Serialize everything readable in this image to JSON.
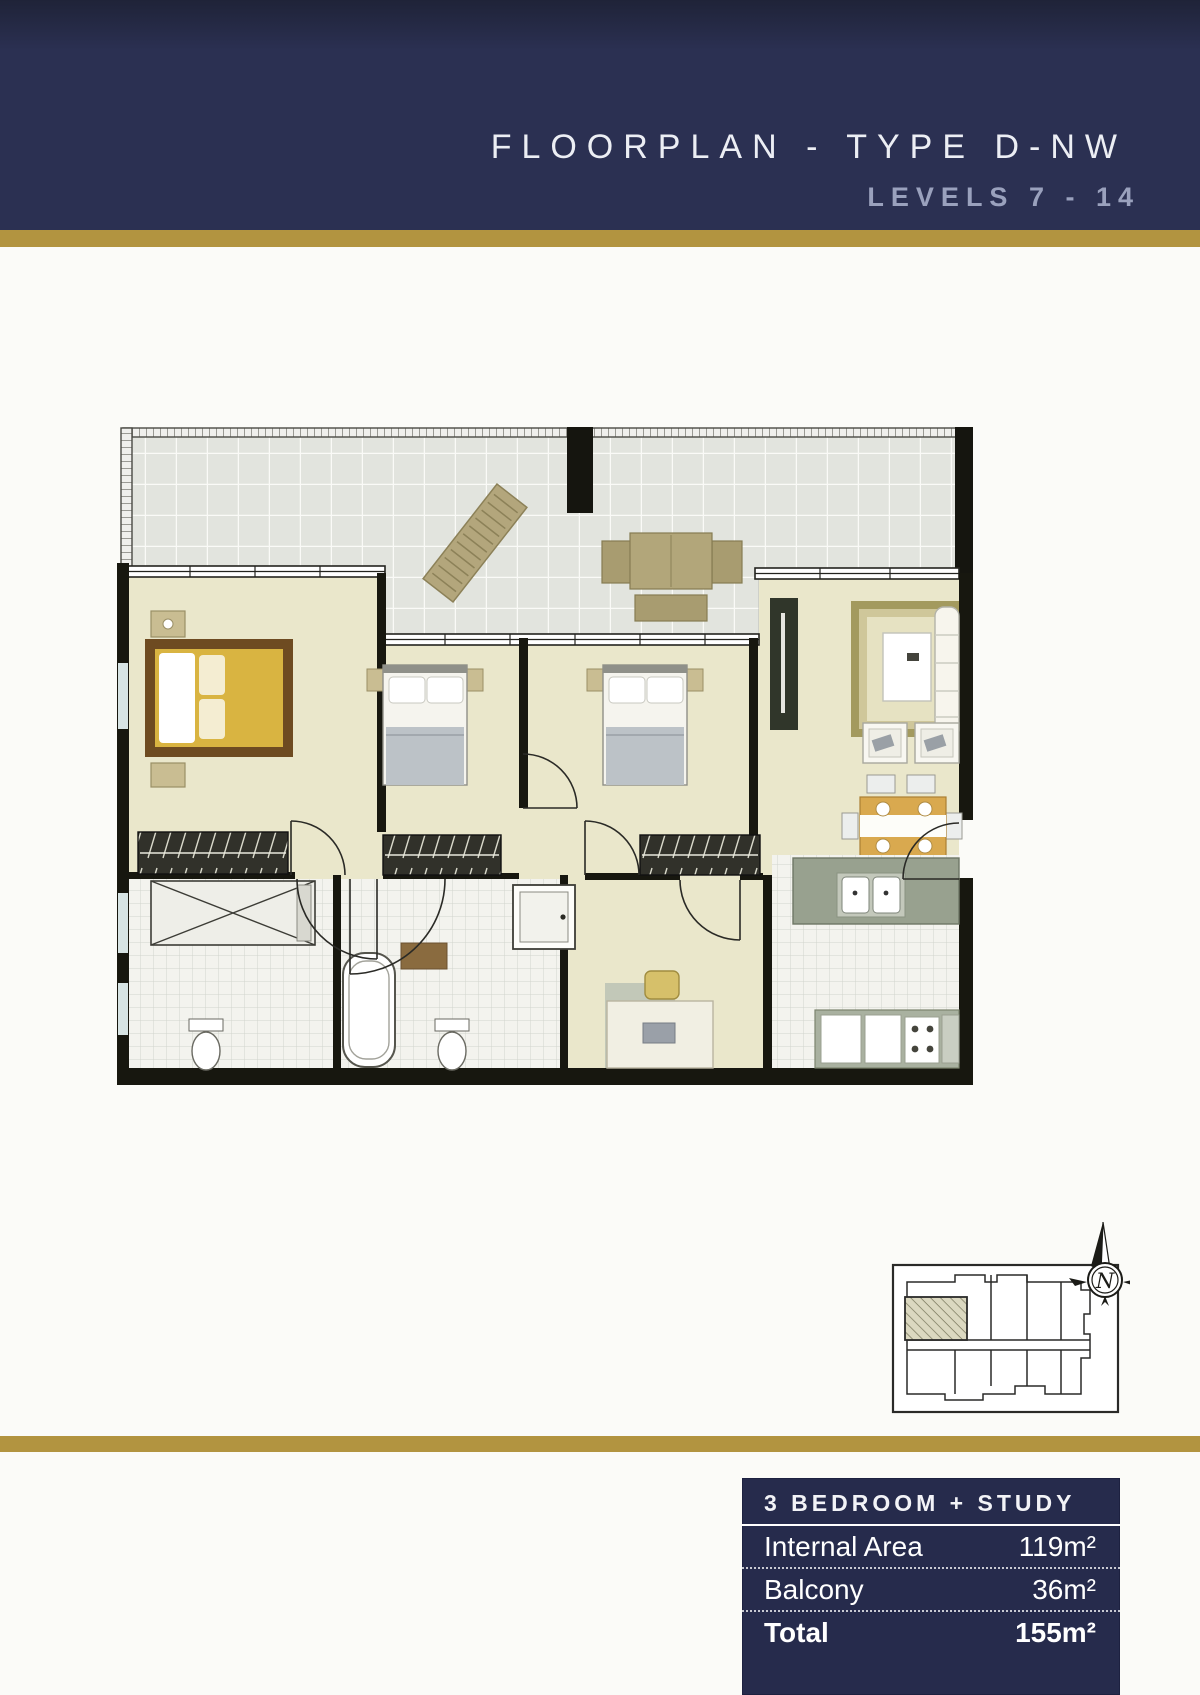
{
  "header": {
    "title": "FLOORPLAN - TYPE D-NW",
    "levels": "LEVELS 7 - 14"
  },
  "colors": {
    "navy": "#2b3052",
    "gold": "#b29440",
    "floor_cream": "#eae7cb",
    "wall_black": "#17170f",
    "kitchen_green": "#98a18f"
  },
  "key_plan": {
    "north": "N"
  },
  "summary": {
    "header": "3 BEDROOM + STUDY",
    "rows": [
      {
        "label": "Internal Area",
        "value": "119m²"
      },
      {
        "label": "Balcony",
        "value": "36m²"
      },
      {
        "label": "Total",
        "value": "155m²"
      }
    ]
  }
}
